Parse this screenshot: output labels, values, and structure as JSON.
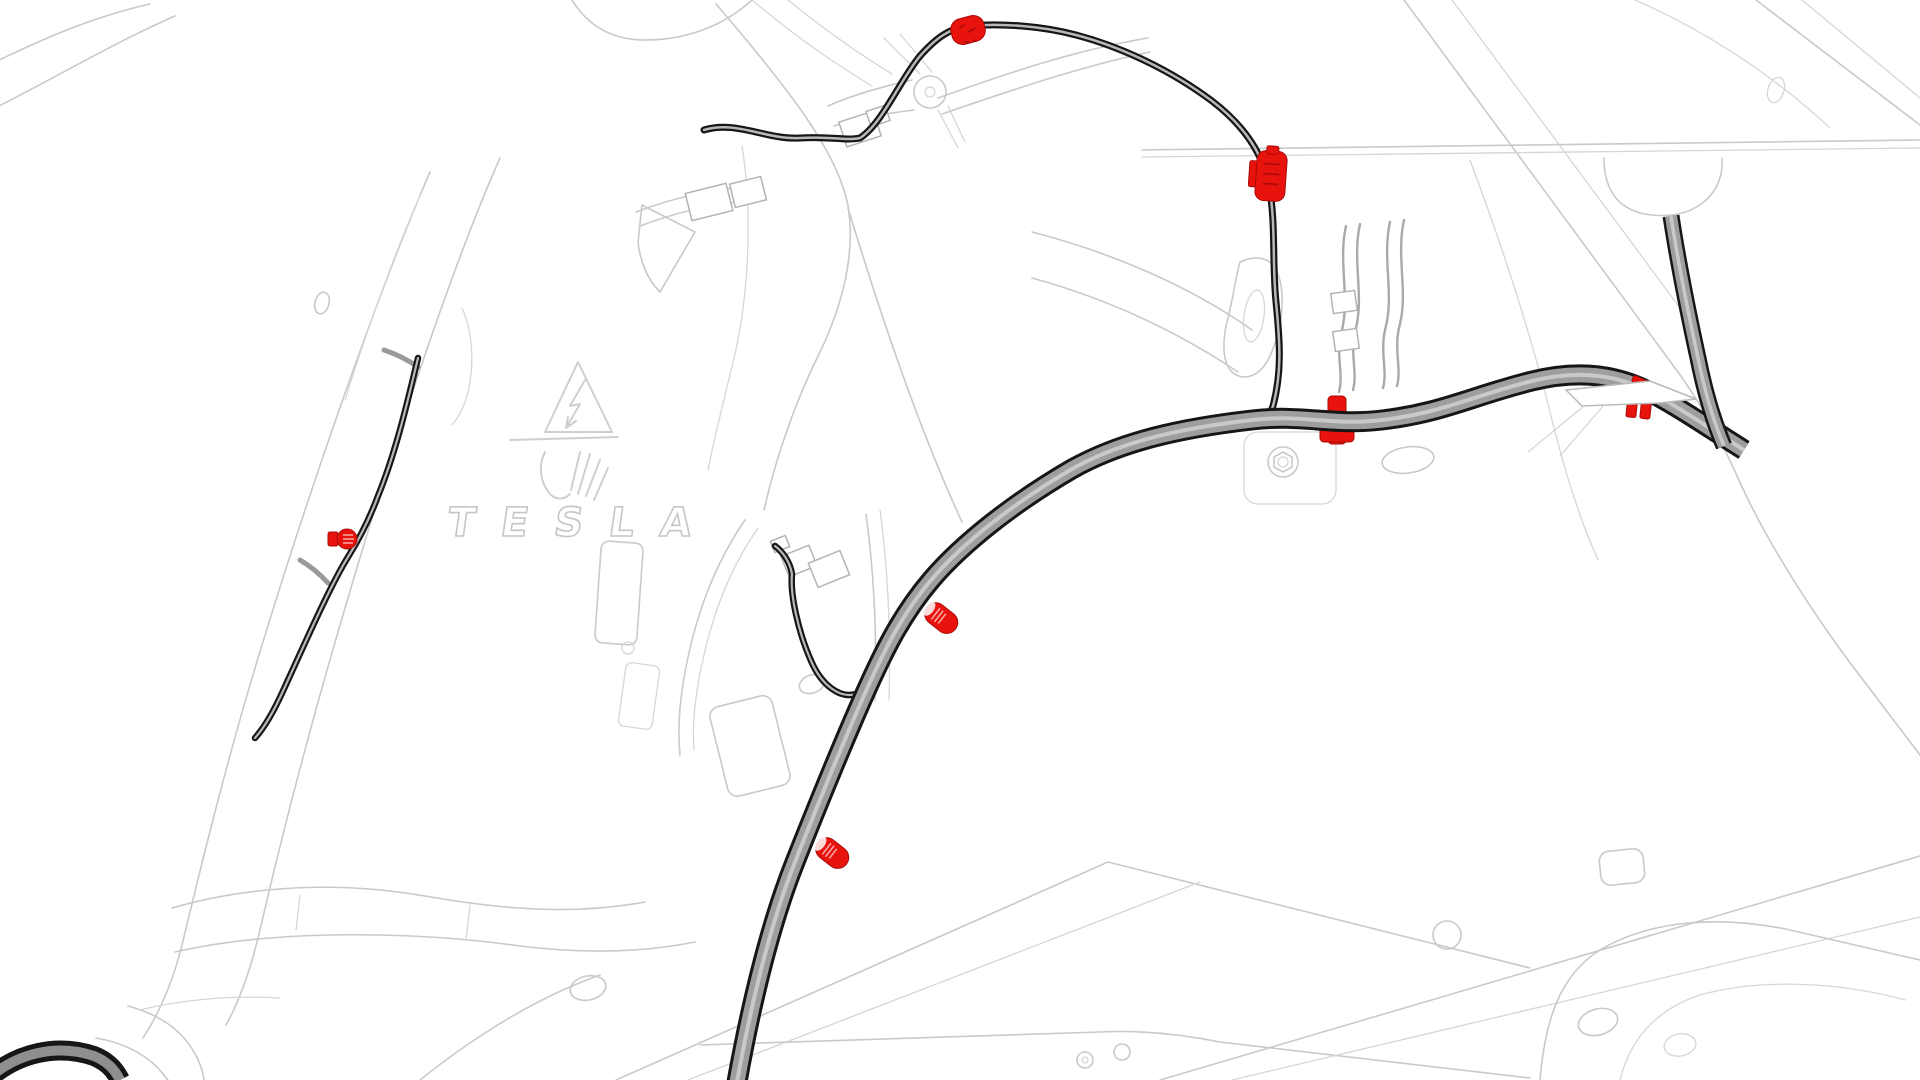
{
  "meta": {
    "title": "Vehicle body wiring-harness routing illustration",
    "background": "#ffffff",
    "canvas": {
      "width": 1920,
      "height": 1080
    }
  },
  "branding": {
    "logo_text": "TESLA"
  },
  "colors": {
    "highlight_red": "#e8130d",
    "highlight_red_dark": "#a80b08",
    "cable_outline": "#161616",
    "cable_core": "#b8b8b8",
    "harness_fill": "#9e9e9e",
    "harness_highlight": "#c9c9c9",
    "linework_gray": "#c9c9c9"
  },
  "symbols": [
    {
      "id": "high-voltage-warning-triangle",
      "label": "high voltage warning triangle"
    },
    {
      "id": "hv-glove-hand-symbol",
      "label": "insulated glove hand symbol"
    }
  ],
  "cables": [
    {
      "id": "signal-cable-left",
      "kind": "thin",
      "d": "M 418 358 C 408 400 396 452 378 496 C 368 523 358 541 348 557 C 330 586 306 641 283 691 C 273 713 263 729 255 738",
      "strokes": [
        {
          "w": 6.5,
          "c": "#161616"
        },
        {
          "w": 2.2,
          "c": "#b8b8b8"
        }
      ]
    },
    {
      "id": "signal-cable-middle-loop",
      "kind": "thin",
      "d": "M 775 546 C 783 552 790 562 792 574 C 790 594 798 632 812 663 C 822 685 840 699 856 694 C 864 691 868 683 866 676",
      "strokes": [
        {
          "w": 6.5,
          "c": "#161616"
        },
        {
          "w": 2.2,
          "c": "#b8b8b8"
        }
      ]
    },
    {
      "id": "signal-cable-upper",
      "kind": "thin",
      "d": "M 704 130 C 736 120 766 140 800 138 C 830 136 846 141 860 138 C 882 124 900 80 920 56 C 936 38 950 28 968 26 C 1002 23 1042 26 1076 35 C 1122 47 1172 71 1212 101 C 1242 124 1263 152 1269 186 C 1276 222 1272 262 1276 302 C 1280 342 1282 372 1273 406 C 1270 415 1265 418 1261 414",
      "strokes": [
        {
          "w": 7,
          "c": "#161616"
        },
        {
          "w": 2.5,
          "c": "#b8b8b8"
        }
      ]
    },
    {
      "id": "harness-loop-bottom-left",
      "kind": "thick",
      "d": "M -12 1079 C 18 1052 58 1044 94 1056 C 106 1061 114 1068 120 1080",
      "strokes": [
        {
          "w": 20,
          "c": "#161616"
        },
        {
          "w": 10,
          "c": "#8e8e8e"
        }
      ]
    },
    {
      "id": "main-harness",
      "kind": "thick",
      "d": "M 737 1082 C 750 1010 768 930 795 862 C 818 804 840 750 862 700 C 884 650 902 614 932 579 C 962 544 1012 504 1072 469 C 1122 441 1182 428 1252 420 C 1302 414 1332 426 1382 420 C 1442 413 1472 396 1532 381 C 1572 371 1612 372 1650 392 C 1682 409 1712 430 1744 450",
      "strokes": [
        {
          "w": 21,
          "c": "#161616"
        },
        {
          "w": 15,
          "c": "#9e9e9e"
        },
        {
          "w": 4,
          "c": "#c9c9c9"
        }
      ]
    },
    {
      "id": "harness-branch-right",
      "kind": "thick",
      "d": "M 1671 216 C 1678 262 1688 312 1698 358 C 1704 388 1712 418 1724 446",
      "strokes": [
        {
          "w": 17,
          "c": "#161616"
        },
        {
          "w": 12,
          "c": "#9e9e9e"
        },
        {
          "w": 3.5,
          "c": "#c9c9c9"
        }
      ]
    }
  ],
  "fasteners": [
    {
      "id": "clip-harness-mid-right",
      "type": "cross-clip",
      "x": 1337,
      "y": 420,
      "rot": 0,
      "layer": "under"
    },
    {
      "id": "clip-harness-bracket",
      "type": "teeth-clip",
      "x": 1639,
      "y": 406,
      "rot": 6,
      "layer": "mid"
    },
    {
      "id": "clip-harness-bracket-tab",
      "type": "sliver",
      "x": 1641,
      "y": 382,
      "rot": 24,
      "layer": "mid"
    },
    {
      "id": "clip-top-cable",
      "type": "blob-clip",
      "x": 968,
      "y": 30,
      "rot": -15,
      "layer": "over"
    },
    {
      "id": "clip-upper-right-cable",
      "type": "canoe-clip",
      "x": 1271,
      "y": 176,
      "rot": 4,
      "layer": "over"
    },
    {
      "id": "clip-left-cable",
      "type": "round-clip",
      "x": 347,
      "y": 539,
      "rot": 0,
      "layer": "over"
    },
    {
      "id": "pin-harness-mid",
      "type": "pin",
      "x": 927,
      "y": 607,
      "rot": 38,
      "layer": "over"
    },
    {
      "id": "pin-harness-lower",
      "type": "pin",
      "x": 818,
      "y": 842,
      "rot": 38,
      "layer": "over"
    }
  ]
}
